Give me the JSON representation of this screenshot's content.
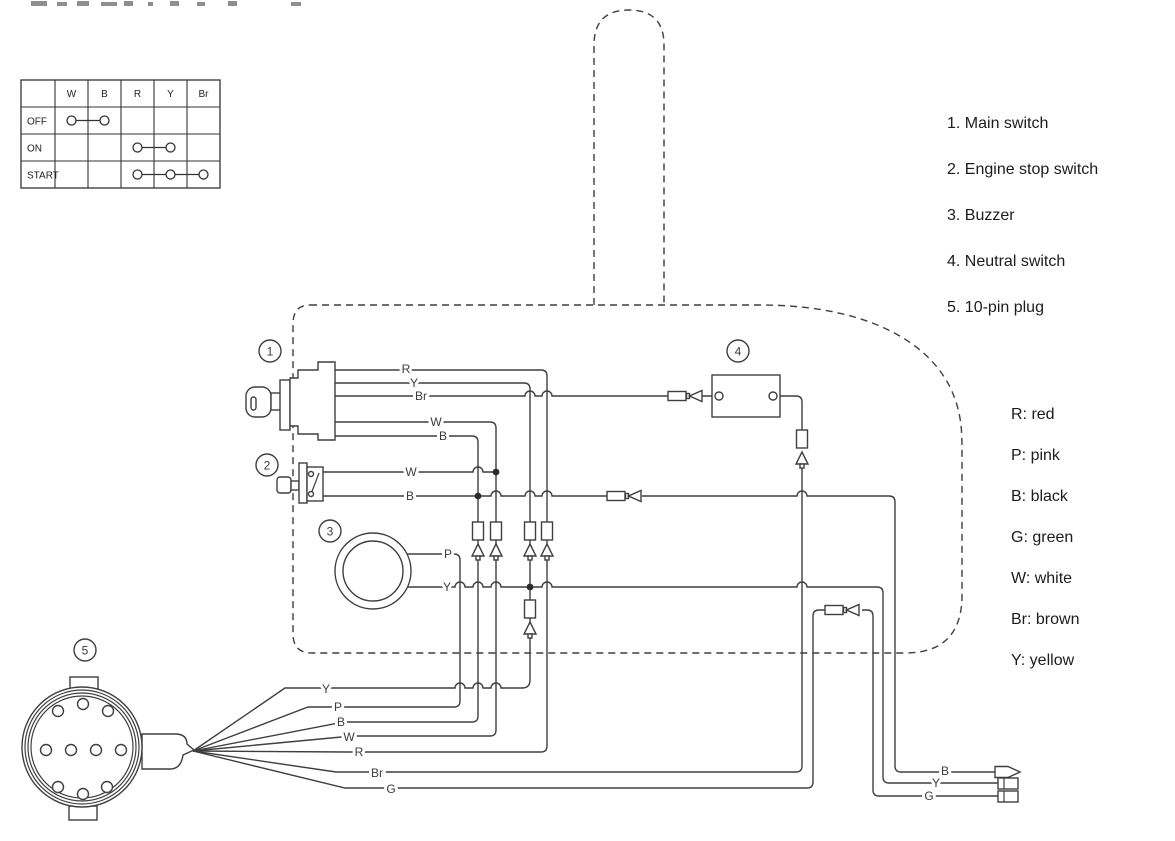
{
  "pinout_table": {
    "column_headers": [
      "W",
      "B",
      "R",
      "Y",
      "Br"
    ],
    "rows": [
      {
        "label": "OFF",
        "connects": [
          "W",
          "B"
        ]
      },
      {
        "label": "ON",
        "connects": [
          "R",
          "Y"
        ]
      },
      {
        "label": "START",
        "connects": [
          "R",
          "Y",
          "Br"
        ]
      }
    ]
  },
  "components": {
    "numbers": [
      "1",
      "2",
      "3",
      "4",
      "5"
    ],
    "legend": [
      "1. Main switch",
      "2. Engine stop switch",
      "3. Buzzer",
      "4. Neutral switch",
      "5. 10-pin plug"
    ]
  },
  "wire_colors_key": [
    "R: red",
    "P: pink",
    "B: black",
    "G: green",
    "W: white",
    "Br: brown",
    "Y: yellow"
  ],
  "wire_labels": {
    "main_switch": [
      "R",
      "Y",
      "Br",
      "W",
      "B"
    ],
    "engine_stop_switch": [
      "W",
      "B"
    ],
    "buzzer": [
      "P",
      "Y"
    ],
    "plug_fanout": [
      "Y",
      "P",
      "B",
      "W",
      "R",
      "Br",
      "G"
    ],
    "right_leads": [
      "B",
      "Y",
      "G"
    ]
  }
}
